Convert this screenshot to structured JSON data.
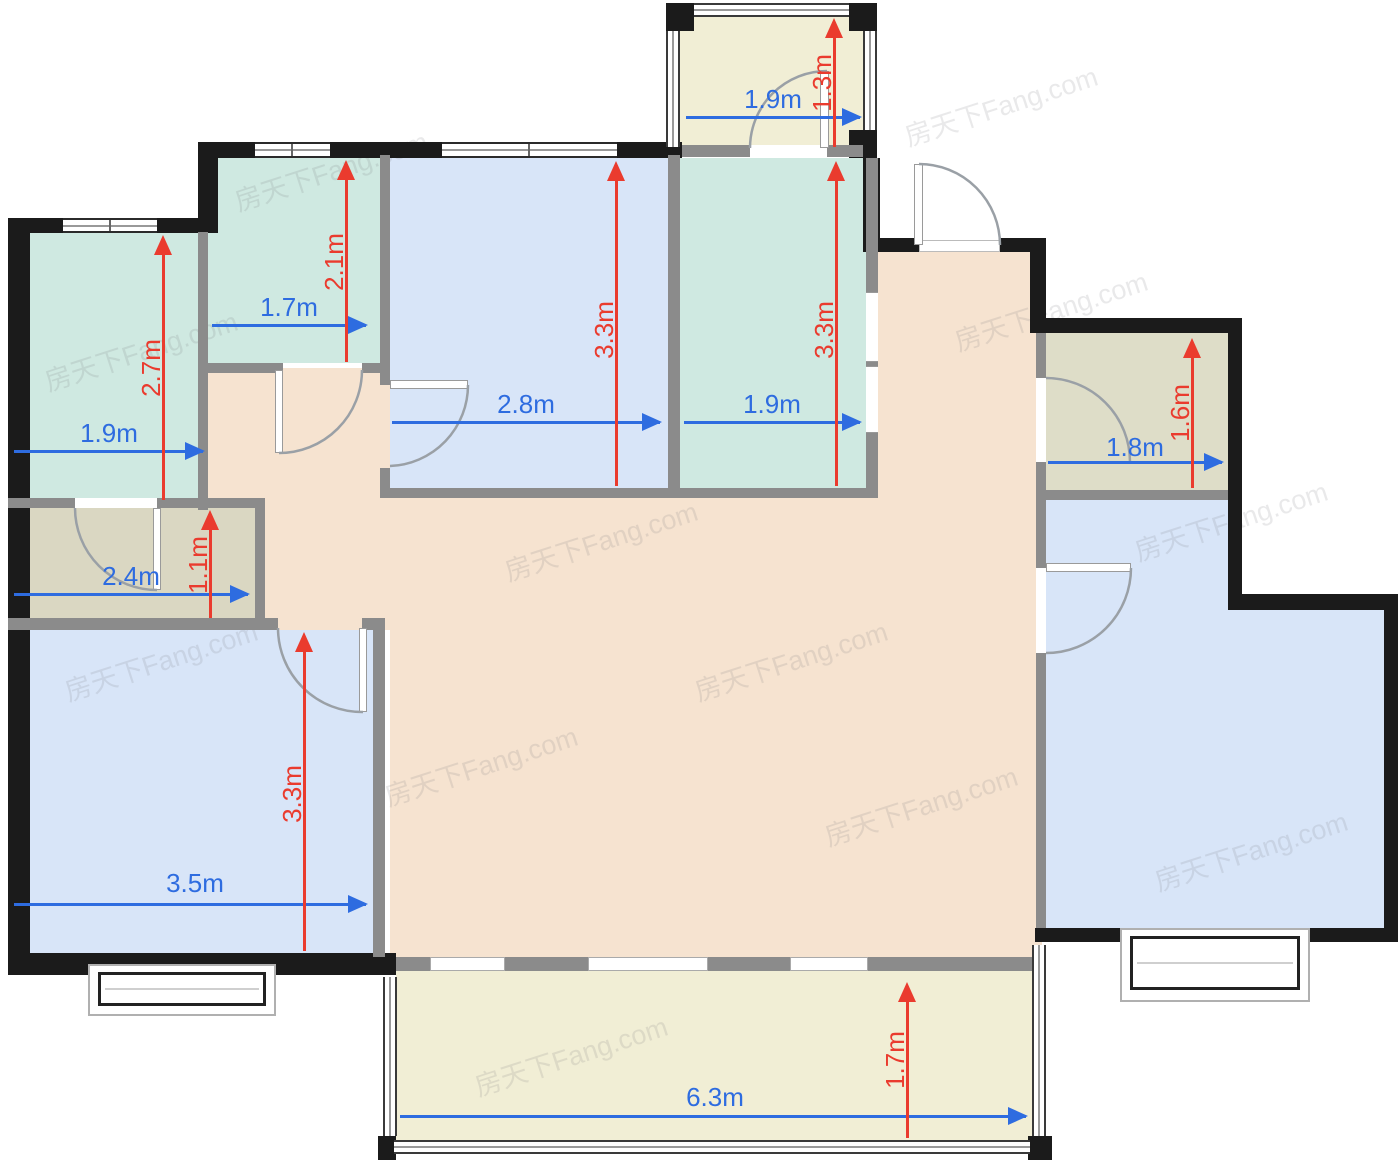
{
  "watermark": {
    "text": "房天下Fang.com"
  },
  "colors": {
    "wall": "#1b1b1b",
    "interior_wall": "#8b8b8b",
    "room_teal": "#cfe9e1",
    "room_blue": "#d8e5f8",
    "room_beige": "#f6e3d0",
    "room_cream": "#f1eed5",
    "room_olive": "#deddc8",
    "room_olive_dark": "#dad7c2",
    "dim_blue": "#2e6ce0",
    "dim_red": "#ea3b2e",
    "door_arc": "#9aa0a6"
  },
  "rooms": [
    {
      "id": "room-top-left",
      "fill": "teal",
      "width": "1.9m",
      "depth": "2.7m"
    },
    {
      "id": "room-top-kitchen",
      "fill": "teal",
      "width": "1.7m",
      "depth": "2.1m"
    },
    {
      "id": "bedroom-top-middle",
      "fill": "blue",
      "width": "2.8m",
      "depth": "3.3m"
    },
    {
      "id": "room-top-right",
      "fill": "teal",
      "width": "1.9m",
      "depth": "3.3m"
    },
    {
      "id": "balcony-top",
      "fill": "cream",
      "width": "1.9m",
      "depth": "1.3m"
    },
    {
      "id": "bathroom-right",
      "fill": "olive",
      "width": "1.8m",
      "depth": "1.6m"
    },
    {
      "id": "bathroom-left",
      "fill": "olive",
      "width": "2.4m",
      "depth": "1.1m"
    },
    {
      "id": "bedroom-bottom-left",
      "fill": "blue",
      "width": "3.5m",
      "depth": "3.3m"
    },
    {
      "id": "living-dining",
      "fill": "beige"
    },
    {
      "id": "bedroom-right",
      "fill": "blue"
    },
    {
      "id": "balcony-bottom",
      "fill": "cream",
      "width": "6.3m",
      "depth": "1.7m"
    }
  ],
  "dims": {
    "h": [
      {
        "id": "room-top-left-width",
        "label": "1.9m"
      },
      {
        "id": "kitchen-width",
        "label": "1.7m"
      },
      {
        "id": "bedroom-top-middle-width",
        "label": "2.8m"
      },
      {
        "id": "room-top-right-width",
        "label": "1.9m"
      },
      {
        "id": "balcony-top-width",
        "label": "1.9m"
      },
      {
        "id": "bathroom-right-width",
        "label": "1.8m"
      },
      {
        "id": "bathroom-left-width",
        "label": "2.4m"
      },
      {
        "id": "bedroom-bottom-left-width",
        "label": "3.5m"
      },
      {
        "id": "balcony-bottom-width",
        "label": "6.3m"
      }
    ],
    "v": [
      {
        "id": "room-top-left-depth",
        "label": "2.7m"
      },
      {
        "id": "kitchen-depth",
        "label": "2.1m"
      },
      {
        "id": "bedroom-top-middle-depth",
        "label": "3.3m"
      },
      {
        "id": "room-top-right-depth",
        "label": "3.3m"
      },
      {
        "id": "balcony-top-depth",
        "label": "1.3m"
      },
      {
        "id": "bathroom-right-depth",
        "label": "1.6m"
      },
      {
        "id": "bathroom-left-depth",
        "label": "1.1m"
      },
      {
        "id": "bedroom-bottom-left-depth",
        "label": "3.3m"
      },
      {
        "id": "balcony-bottom-depth",
        "label": "1.7m"
      }
    ]
  }
}
